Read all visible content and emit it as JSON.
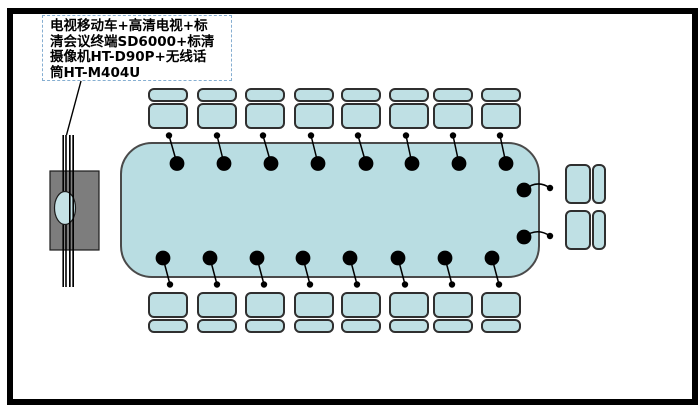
{
  "diagram": {
    "title": "conference-room-av-layout",
    "label": {
      "lines": [
        "电视移动车+高清电视+标",
        "清会议终端SD6000+标清",
        "摄像机HT-D90P+无线话",
        "筒HT-M404U"
      ]
    },
    "colors": {
      "frame": "#000000",
      "table_fill": "#b9dde2",
      "seat_fill": "#bfe0e4",
      "table_border": "#4a4a4a",
      "chair_border": "#2f2f2f",
      "stand_fill": "#7d7d7d",
      "stand_border": "#1c1c1c",
      "screen_fill": "#c5e2e6",
      "label_border": "#85aed1",
      "label_text": "#000000",
      "line": "#000000"
    },
    "table": {
      "x": 120,
      "y": 142,
      "w": 420,
      "h": 136,
      "radius": 32
    },
    "chairs": {
      "top": {
        "y": 88,
        "xs": [
          148,
          197,
          245,
          294,
          341,
          389,
          433,
          481
        ]
      },
      "bottom": {
        "y": 292,
        "xs": [
          148,
          197,
          245,
          294,
          341,
          389,
          433,
          481
        ]
      },
      "right": {
        "x": 565,
        "ys": [
          164,
          210
        ]
      }
    },
    "mics": {
      "big_r": 7.4,
      "small_r": 3.2,
      "top": [
        {
          "sx": 169,
          "sy": 135.5,
          "bx": 177,
          "by": 163.5
        },
        {
          "sx": 217,
          "sy": 135.5,
          "bx": 224,
          "by": 163.5
        },
        {
          "sx": 263,
          "sy": 135.5,
          "bx": 271,
          "by": 163.5
        },
        {
          "sx": 311,
          "sy": 135.5,
          "bx": 318,
          "by": 163.5
        },
        {
          "sx": 358,
          "sy": 135.5,
          "bx": 366,
          "by": 163.5
        },
        {
          "sx": 406,
          "sy": 135.5,
          "bx": 412,
          "by": 163.5
        },
        {
          "sx": 453,
          "sy": 135.5,
          "bx": 459,
          "by": 163.5
        },
        {
          "sx": 500,
          "sy": 135.5,
          "bx": 506,
          "by": 163.5
        }
      ],
      "bottom": [
        {
          "sx": 170,
          "sy": 284.5,
          "bx": 163,
          "by": 258
        },
        {
          "sx": 217,
          "sy": 284.5,
          "bx": 210,
          "by": 258
        },
        {
          "sx": 264,
          "sy": 284.5,
          "bx": 257,
          "by": 258
        },
        {
          "sx": 310,
          "sy": 284.5,
          "bx": 303,
          "by": 258
        },
        {
          "sx": 357,
          "sy": 284.5,
          "bx": 350,
          "by": 258
        },
        {
          "sx": 405,
          "sy": 284.5,
          "bx": 398,
          "by": 258
        },
        {
          "sx": 452,
          "sy": 284.5,
          "bx": 445,
          "by": 258
        },
        {
          "sx": 499,
          "sy": 284.5,
          "bx": 492,
          "by": 258
        }
      ],
      "right": [
        {
          "sx": 550,
          "sy": 188,
          "bx": 524,
          "by": 190,
          "bow": -9
        },
        {
          "sx": 550,
          "sy": 236,
          "bx": 524,
          "by": 237,
          "bow": -9
        }
      ]
    },
    "cart": {
      "rails": {
        "xs": [
          63.2,
          66,
          69.8,
          73.2
        ],
        "y1": 135,
        "y2": 287,
        "w": 1.6
      },
      "stand": {
        "x": 50,
        "y": 171,
        "w": 49,
        "h": 79
      },
      "screen": {
        "cx": 65,
        "cy": 208,
        "rx": 10.5,
        "ry": 16.5
      }
    },
    "leader_line": {
      "x1": 81,
      "y1": 81,
      "x2": 66.5,
      "y2": 135
    }
  }
}
